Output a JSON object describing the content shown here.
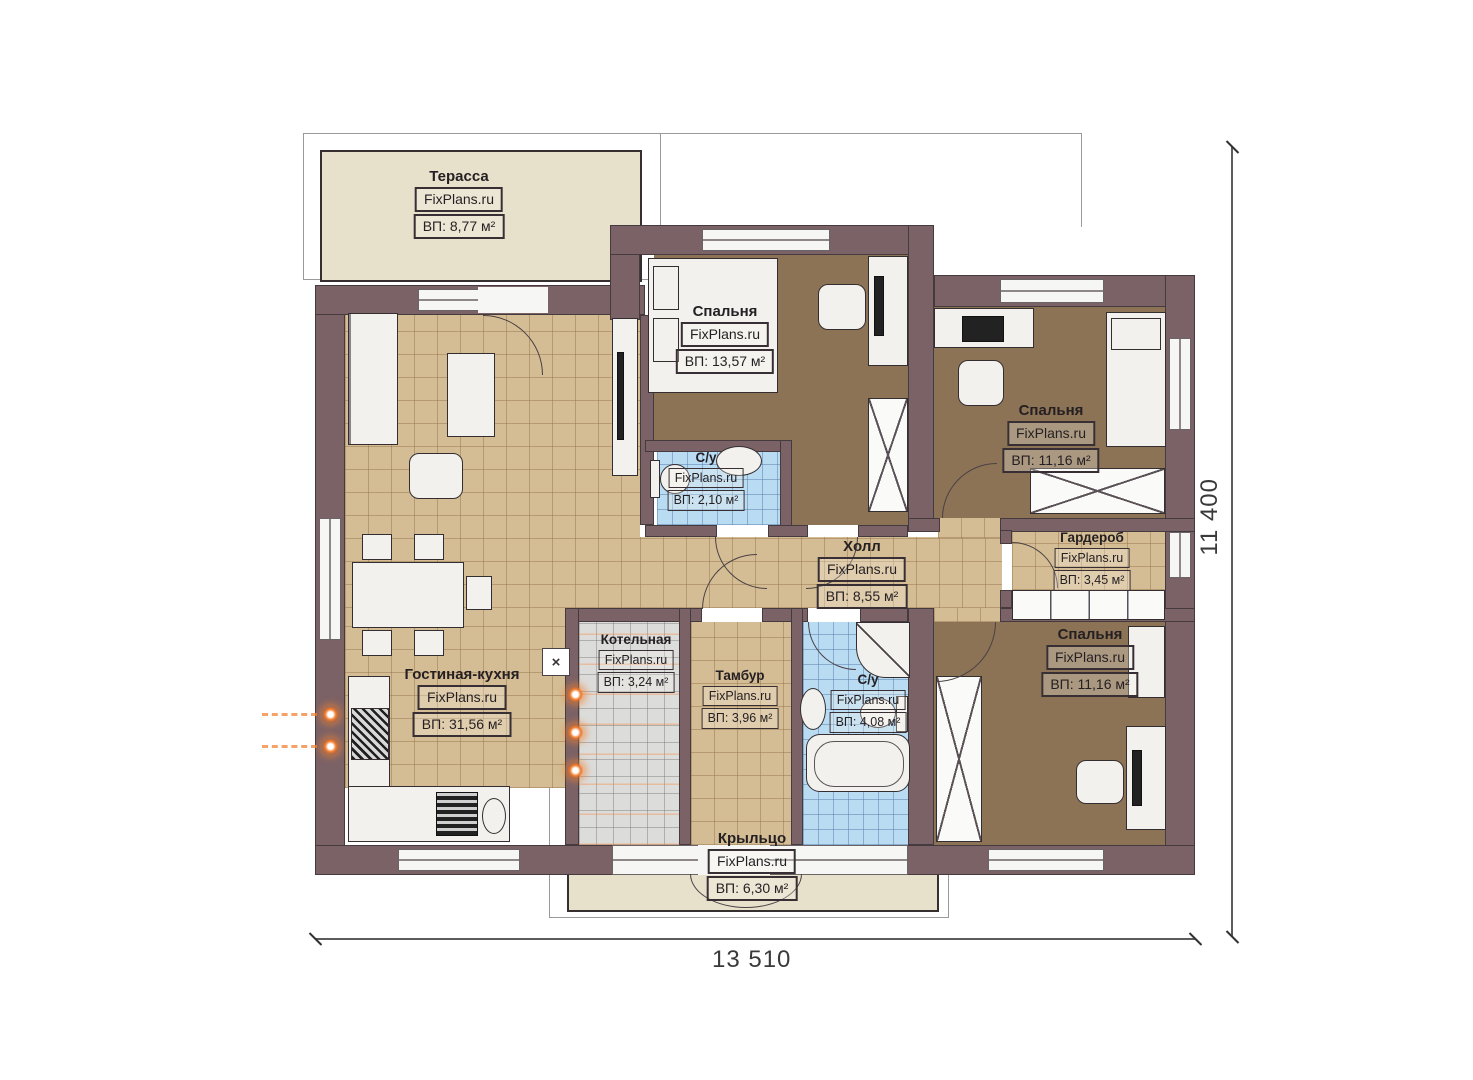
{
  "plan": {
    "brand": "FixPlans.ru",
    "rooms": [
      {
        "key": "terrace",
        "name": "Терасса",
        "area": "ВП: 8,77 м²"
      },
      {
        "key": "living-kitchen",
        "name": "Гостиная-кухня",
        "area": "ВП: 31,56 м²"
      },
      {
        "key": "bedroom-top",
        "name": "Спальня",
        "area": "ВП: 13,57 м²"
      },
      {
        "key": "wc-small",
        "name": "С/у",
        "area": "ВП: 2,10 м²"
      },
      {
        "key": "hall",
        "name": "Холл",
        "area": "ВП: 8,55 м²"
      },
      {
        "key": "wardrobe-room",
        "name": "Гардероб",
        "area": "ВП: 3,45 м²"
      },
      {
        "key": "bedroom-right",
        "name": "Спальня",
        "area": "ВП: 11,16 м²"
      },
      {
        "key": "boiler-room",
        "name": "Котельная",
        "area": "ВП: 3,24 м²"
      },
      {
        "key": "vestibule",
        "name": "Тамбур",
        "area": "ВП: 3,96 м²"
      },
      {
        "key": "wc-big",
        "name": "С/у",
        "area": "ВП: 4,08 м²"
      },
      {
        "key": "bedroom-bottom",
        "name": "Спальня",
        "area": "ВП: 11,16 м²"
      },
      {
        "key": "porch",
        "name": "Крыльцо",
        "area": "ВП: 6,30 м²"
      }
    ],
    "dimensions": {
      "width": "13 510",
      "height": "11 400"
    },
    "symbols": {
      "vent": "×"
    },
    "colors": {
      "wall": "#7b6266",
      "floor_tile_tan": "#d4bd94",
      "floor_brown": "#8c7355",
      "floor_tile_blue": "#b9dcf2",
      "floor_tile_gray": "#dcdcda",
      "outdoor_beige": "#e7e0cb",
      "accent_orange": "#f07828"
    }
  }
}
